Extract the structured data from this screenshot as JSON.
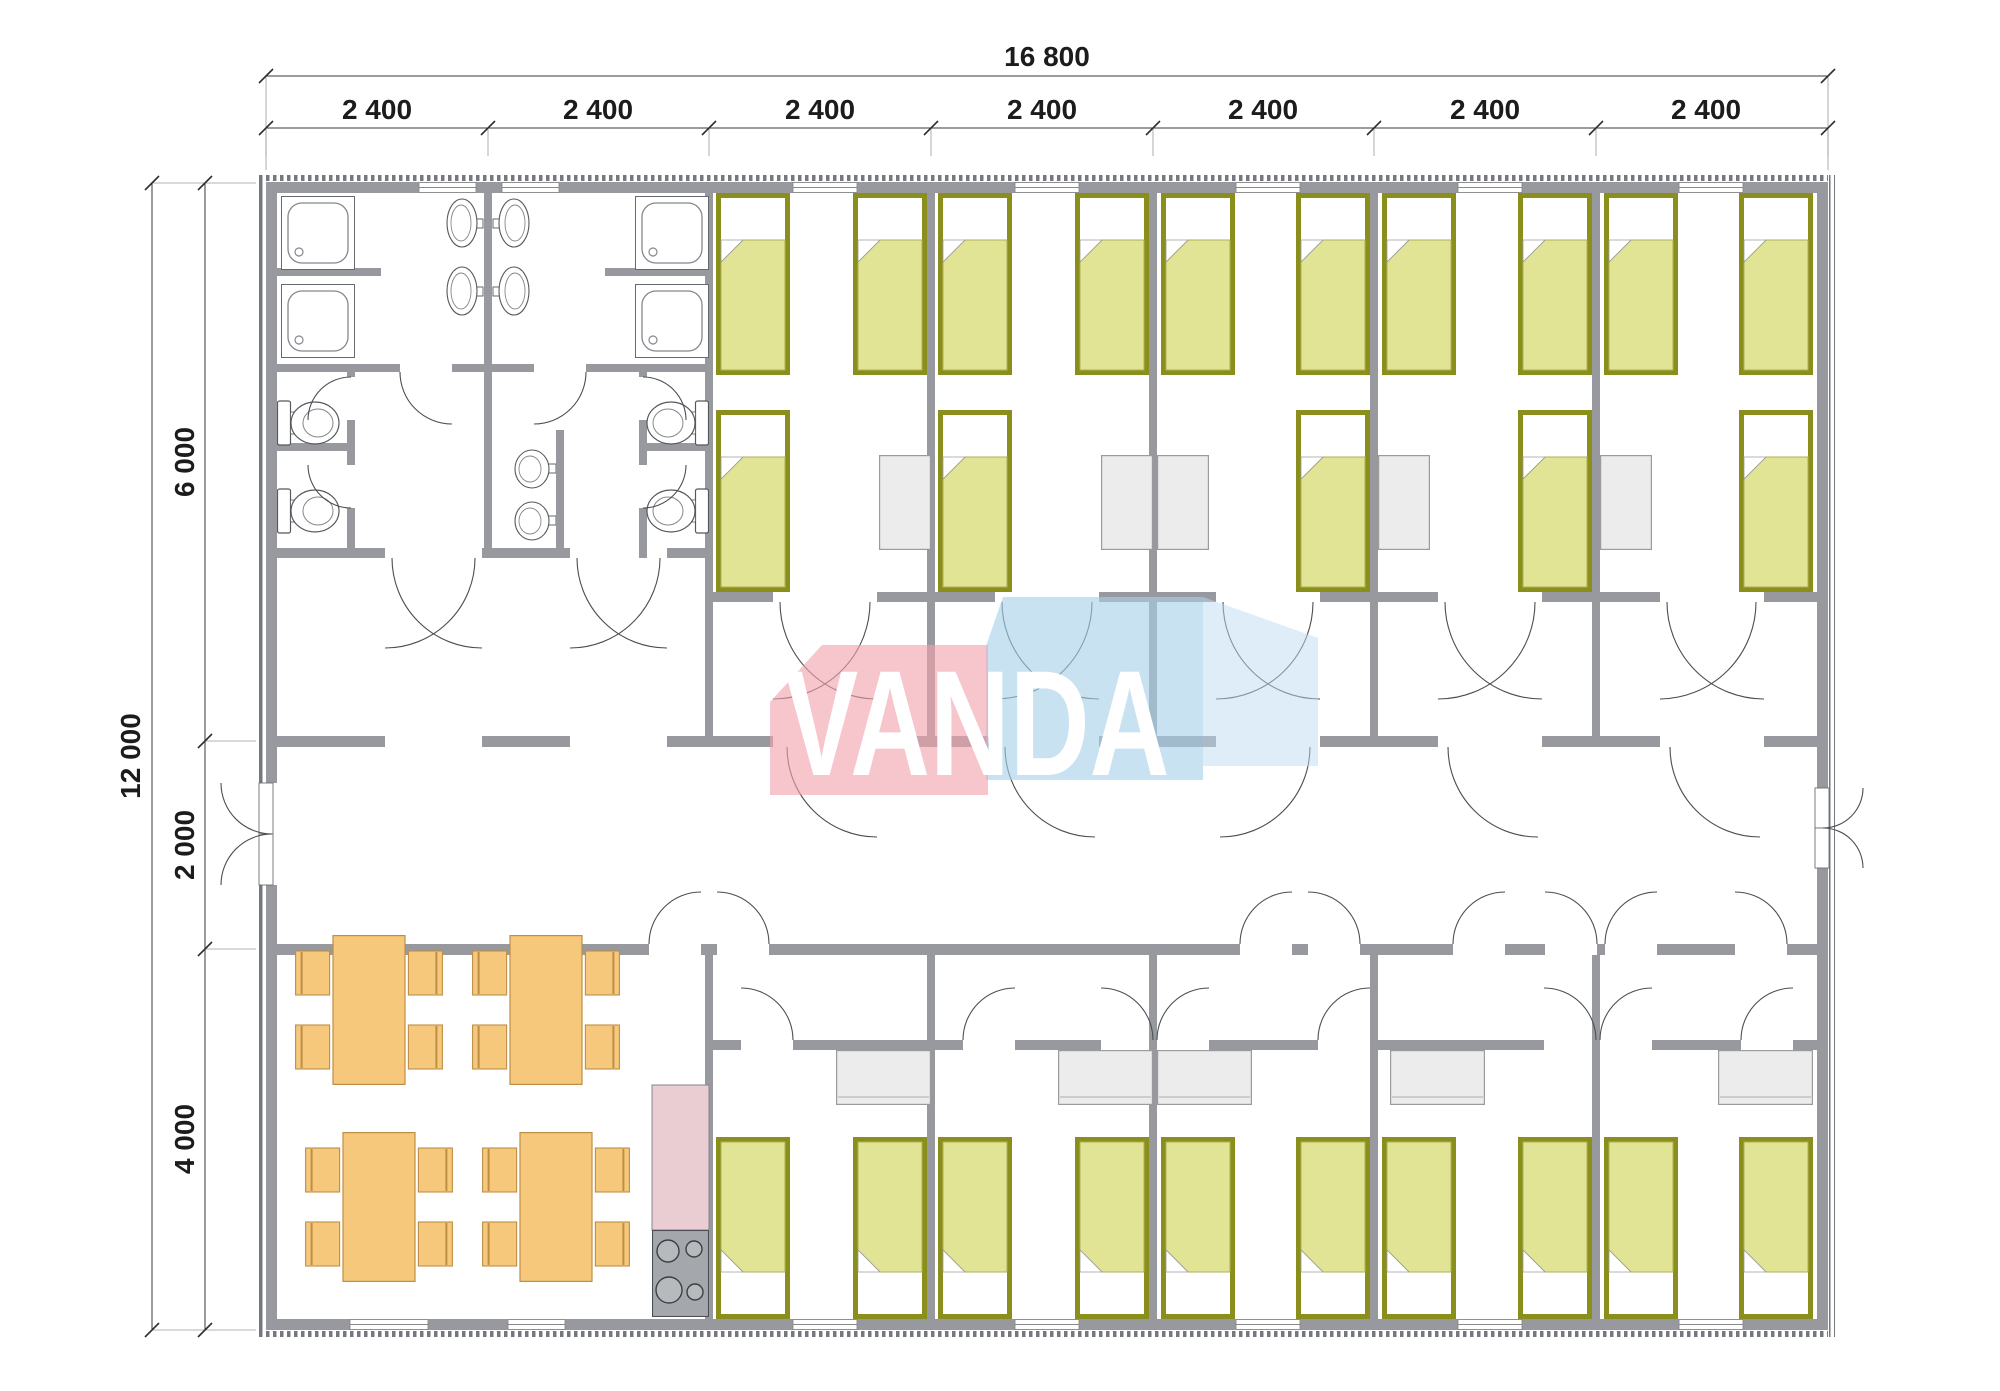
{
  "document": {
    "kind": "modular building floor plan",
    "brand": "VANDA"
  },
  "dimensions": {
    "top_total": "16 800",
    "top_segments": [
      "2 400",
      "2 400",
      "2 400",
      "2 400",
      "2 400",
      "2 400",
      "2 400"
    ],
    "left_total": "12 000",
    "left_segments": [
      "6 000",
      "2 000",
      "4 000"
    ]
  },
  "logo": {
    "text": "VANDA",
    "pink_block": "#F0A3AD",
    "blue_block": "#A8D0E9"
  },
  "palette": {
    "wall": "#97999E",
    "bed_frame": "#8A8E1A",
    "bed_blanket": "#E0E494",
    "pillow": "#FFFFFF",
    "desk": "#ECECEC",
    "dining_table": "#F5C87C",
    "kitchen_counter": "#EACCD3",
    "stove": "#A4A8AC",
    "door_arc": "#4B4E52"
  },
  "fixtures": {
    "single_beds": 25,
    "study_desks": 10,
    "dining_tables": 4,
    "chairs": 16,
    "showers": 4,
    "toilets": 4,
    "wash_basins": 6,
    "cooktops": 1
  }
}
